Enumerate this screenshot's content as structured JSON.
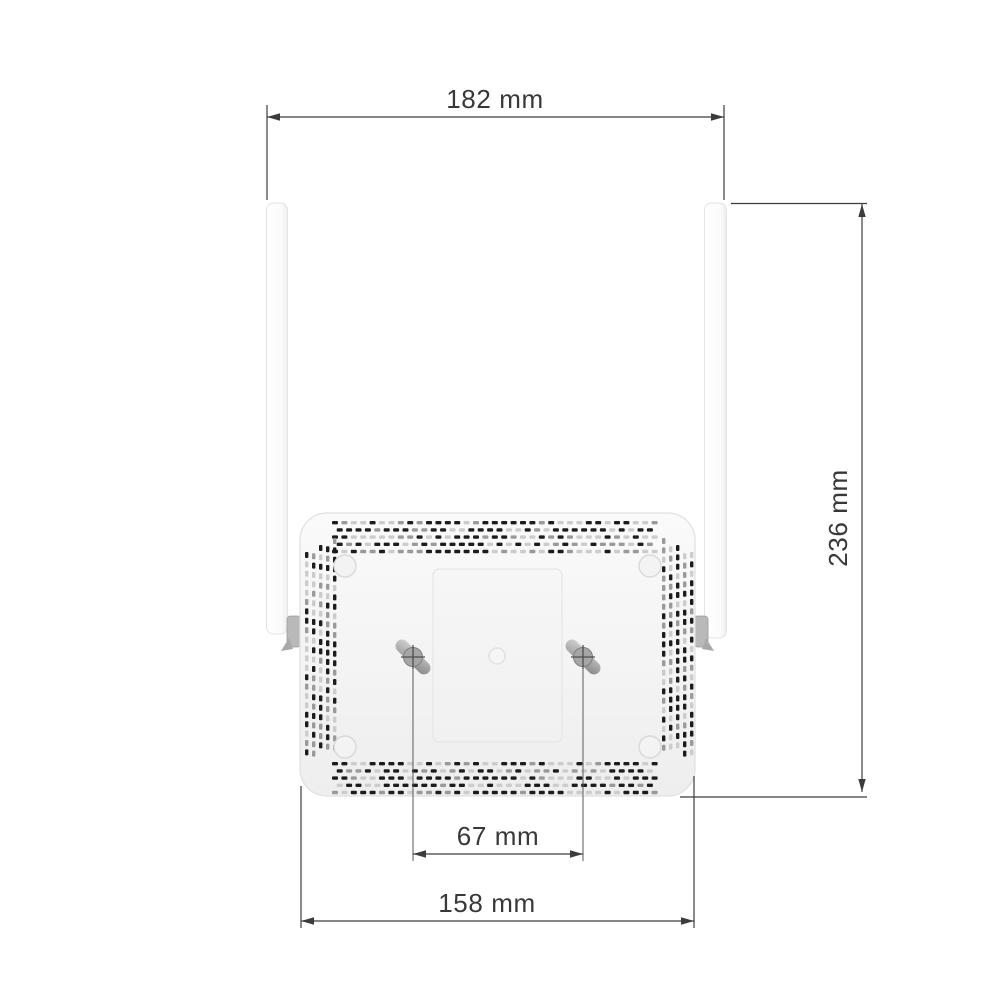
{
  "figure": {
    "subject": "wireless-router-bottom-view-with-two-antennas",
    "kind": "technical dimension drawing"
  },
  "dimensions": {
    "antenna_span": "182 mm",
    "device_height": "236 mm",
    "mount_hole_spacing": "67 mm",
    "body_width": "158 mm"
  },
  "colors": {
    "background": "#ffffff",
    "dimension_line": "#3c3c3c",
    "label_text": "#383838",
    "body_fill_top": "#fafafa",
    "body_fill_bottom": "#efefef",
    "body_stroke": "#e0e0e0",
    "antenna_fill": "#fdfdfd",
    "vent_dark": "#1c1c1c",
    "vent_mid": "#9a9a9a",
    "vent_light": "#cccccc",
    "screw_metal": "#a6a6a6"
  }
}
